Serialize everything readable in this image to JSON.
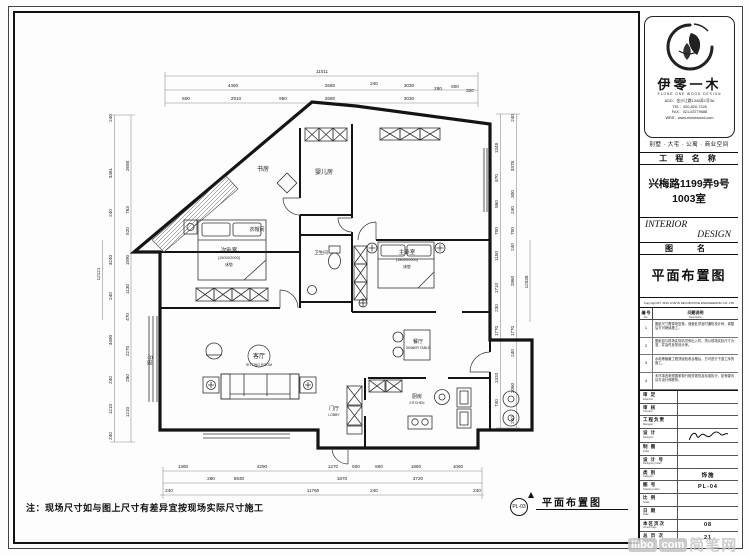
{
  "brand": {
    "name_cn": "伊零一木",
    "name_en": "ELONE ONE WOOD DESIGN",
    "lines": [
      "ADD：金沙江路1340弄1号3A",
      "TEL：400-820-7226",
      "FAX：021-63779588",
      "WEB：www.elonewood.com"
    ],
    "scope": "别墅 · 大宅 · 公寓 · 商业空间"
  },
  "title_block": {
    "project_label": "工 程 名 称",
    "project_name_1": "兴梅路1199弄9号",
    "project_name_2": "1003室",
    "interior": "INTERIOR",
    "design": "DESIGN",
    "drawing_label": "图　名",
    "drawing_name": "平面布置图",
    "copyright": "Copyright BY JING LIVE'IN DECORATIVE ENGINEERING CO.,LTD"
  },
  "notes": {
    "no_header": "编 号",
    "no_header_en": "No.",
    "desc_header": "问题说明",
    "desc_header_en": "Description",
    "rows": [
      {
        "no": "1",
        "text": "图纸尺寸需现场复核，误差处须及时通知设计师，调整后方可继续施工。"
      },
      {
        "no": "2",
        "text": "图纸如与现场实际情况有出入时，须以现场实际尺寸为准，并及时反馈设计师。"
      },
      {
        "no": "3",
        "text": "水电等隐蔽工程须经验收合格后，方可进行下道工序的施工。"
      },
      {
        "no": "4",
        "text": "未尽事宜参照国家现行相关规范及标准执行，如有疑问请与设计师联系。"
      }
    ]
  },
  "sign_rows": [
    {
      "label": "审 定",
      "en": "Examine",
      "value": ""
    },
    {
      "label": "审 核",
      "en": "Checker",
      "value": ""
    },
    {
      "label": "工程负责",
      "en": "Manager",
      "value": ""
    },
    {
      "label": "设 计",
      "en": "Designer",
      "value": "",
      "sig": true
    },
    {
      "label": "制 图",
      "en": "Draw",
      "value": ""
    },
    {
      "label": "设 计 号",
      "en": "Designing Index",
      "value": ""
    },
    {
      "label": "类 别",
      "en": "Category",
      "value": "饰施"
    },
    {
      "label": "图 号",
      "en": "Drawing Index",
      "value": "PL-04"
    },
    {
      "label": "比 例",
      "en": "Scale",
      "value": ""
    },
    {
      "label": "日 期",
      "en": "Date",
      "value": ""
    },
    {
      "label": "本区页次",
      "en": "Amed Page",
      "value": "08"
    },
    {
      "label": "总 页 次",
      "en": "Total Page",
      "value": "21"
    }
  ],
  "footer": {
    "site_note": "注：现场尺寸如与图上尺寸有差异宜按现场实际尺寸施工",
    "sheet_tag": "PL-03",
    "sheet_label": "平面布置图"
  },
  "watermark": {
    "a": "IIIbo",
    "b": "com",
    "c": "简笔网"
  },
  "plan": {
    "room_labels": [
      [
        "书房",
        263,
        171,
        6
      ],
      [
        "婴儿房",
        324,
        174,
        6
      ],
      [
        "衣帽间",
        257,
        231,
        5
      ],
      [
        "次卧室",
        229,
        252,
        5.5
      ],
      [
        "[1500X2000]",
        229,
        259,
        3.8
      ],
      [
        "床垫",
        229,
        266,
        3.8
      ],
      [
        "主卧室",
        407,
        254,
        5.5
      ],
      [
        "[1800X2000]",
        407,
        261,
        3.8
      ],
      [
        "床垫",
        407,
        268,
        3.8
      ],
      [
        "卫生间",
        321,
        254,
        4.5
      ],
      [
        "客厅",
        259,
        358,
        6
      ],
      [
        "SITTING ROOM",
        259,
        366,
        3.6
      ],
      [
        "餐厅",
        418,
        343,
        5
      ],
      [
        "DINNER TABLE",
        418,
        349,
        3.4
      ],
      [
        "厨房",
        417,
        398,
        5
      ],
      [
        "KITCHEN",
        417,
        404,
        3.4
      ],
      [
        "门厅",
        334,
        410,
        5
      ],
      [
        "LOBBY",
        334,
        416,
        3.4
      ],
      [
        "阳台",
        152,
        360,
        5,
        1
      ]
    ],
    "dims": [
      [
        "11011",
        322,
        73
      ],
      [
        "4460",
        233,
        87
      ],
      [
        "2680",
        330,
        87
      ],
      [
        "240",
        374,
        85
      ],
      [
        "3030",
        409,
        87
      ],
      [
        "280",
        438,
        90
      ],
      [
        "600",
        455,
        88
      ],
      [
        "320",
        470,
        92
      ],
      [
        "600",
        186,
        100
      ],
      [
        "2910",
        236,
        100
      ],
      [
        "950",
        283,
        100
      ],
      [
        "2680",
        330,
        100
      ],
      [
        "3030",
        409,
        100
      ],
      [
        "1360",
        183,
        468
      ],
      [
        "4290",
        262,
        468
      ],
      [
        "1270",
        333,
        468
      ],
      [
        "600",
        356,
        468
      ],
      [
        "800",
        379,
        468
      ],
      [
        "1860",
        416,
        468
      ],
      [
        "1060",
        458,
        468
      ],
      [
        "280",
        211,
        480
      ],
      [
        "5930",
        239,
        480
      ],
      [
        "1870",
        342,
        480
      ],
      [
        "3720",
        418,
        480
      ],
      [
        "240",
        169,
        492
      ],
      [
        "11760",
        313,
        492
      ],
      [
        "240",
        374,
        492
      ],
      [
        "240",
        477,
        492
      ],
      [
        "240",
        112,
        118,
        1
      ],
      [
        "3461",
        112,
        173,
        1
      ],
      [
        "240",
        112,
        213,
        1
      ],
      [
        "3240",
        112,
        260,
        1
      ],
      [
        "240",
        112,
        296,
        1
      ],
      [
        "3490",
        112,
        340,
        1
      ],
      [
        "240",
        112,
        380,
        1
      ],
      [
        "1210",
        112,
        409,
        1
      ],
      [
        "240",
        112,
        436,
        1
      ],
      [
        "2658",
        129,
        166,
        1
      ],
      [
        "763",
        129,
        210,
        1
      ],
      [
        "520",
        129,
        231,
        1
      ],
      [
        "1590",
        129,
        260,
        1
      ],
      [
        "1130",
        129,
        289,
        1
      ],
      [
        "470",
        129,
        317,
        1
      ],
      [
        "2270",
        129,
        351,
        1
      ],
      [
        "280",
        129,
        378,
        1
      ],
      [
        "1210",
        129,
        412,
        1
      ],
      [
        "12121",
        100,
        274,
        1
      ],
      [
        "1348",
        498,
        148,
        1
      ],
      [
        "870",
        498,
        178,
        1
      ],
      [
        "860",
        498,
        204,
        1
      ],
      [
        "700",
        498,
        231,
        1
      ],
      [
        "1150",
        498,
        256,
        1
      ],
      [
        "1710",
        498,
        288,
        1
      ],
      [
        "230",
        498,
        308,
        1
      ],
      [
        "1770",
        498,
        331,
        1
      ],
      [
        "1320",
        498,
        378,
        1
      ],
      [
        "740",
        498,
        403,
        1
      ],
      [
        "240",
        514,
        118,
        1
      ],
      [
        "3378",
        514,
        166,
        1
      ],
      [
        "300",
        514,
        194,
        1
      ],
      [
        "240",
        514,
        210,
        1
      ],
      [
        "700",
        514,
        231,
        1
      ],
      [
        "240",
        514,
        247,
        1
      ],
      [
        "2860",
        514,
        281,
        1
      ],
      [
        "1770",
        514,
        331,
        1
      ],
      [
        "240",
        514,
        353,
        1
      ],
      [
        "2060",
        514,
        388,
        1
      ],
      [
        "240",
        514,
        420,
        1
      ],
      [
        "12038",
        528,
        282,
        1
      ]
    ]
  }
}
